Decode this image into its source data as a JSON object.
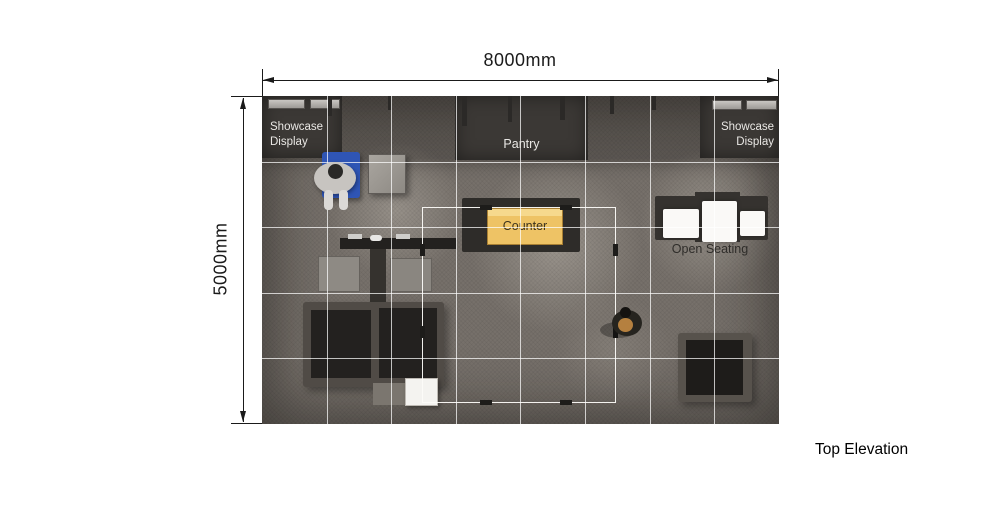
{
  "page": {
    "caption": "Top Elevation"
  },
  "dimensions": {
    "width": "8000mm",
    "height": "5000mm"
  },
  "plan": {
    "labels": {
      "showcase_left": "Showcase Display",
      "pantry": "Pantry",
      "counter": "Counter",
      "open_seating": "Open Seating",
      "showcase_right": "Showcase Display"
    },
    "colors": {
      "floor_base": "#76706a",
      "wall_zone_dark": "#3b3835",
      "counter_yellow": "#eec365",
      "grid_line": "#ffffff",
      "seat_white": "#faf9f7",
      "visitor_chair_blue": "#2f55b5",
      "dimension_ink": "#1a1a1a"
    }
  }
}
